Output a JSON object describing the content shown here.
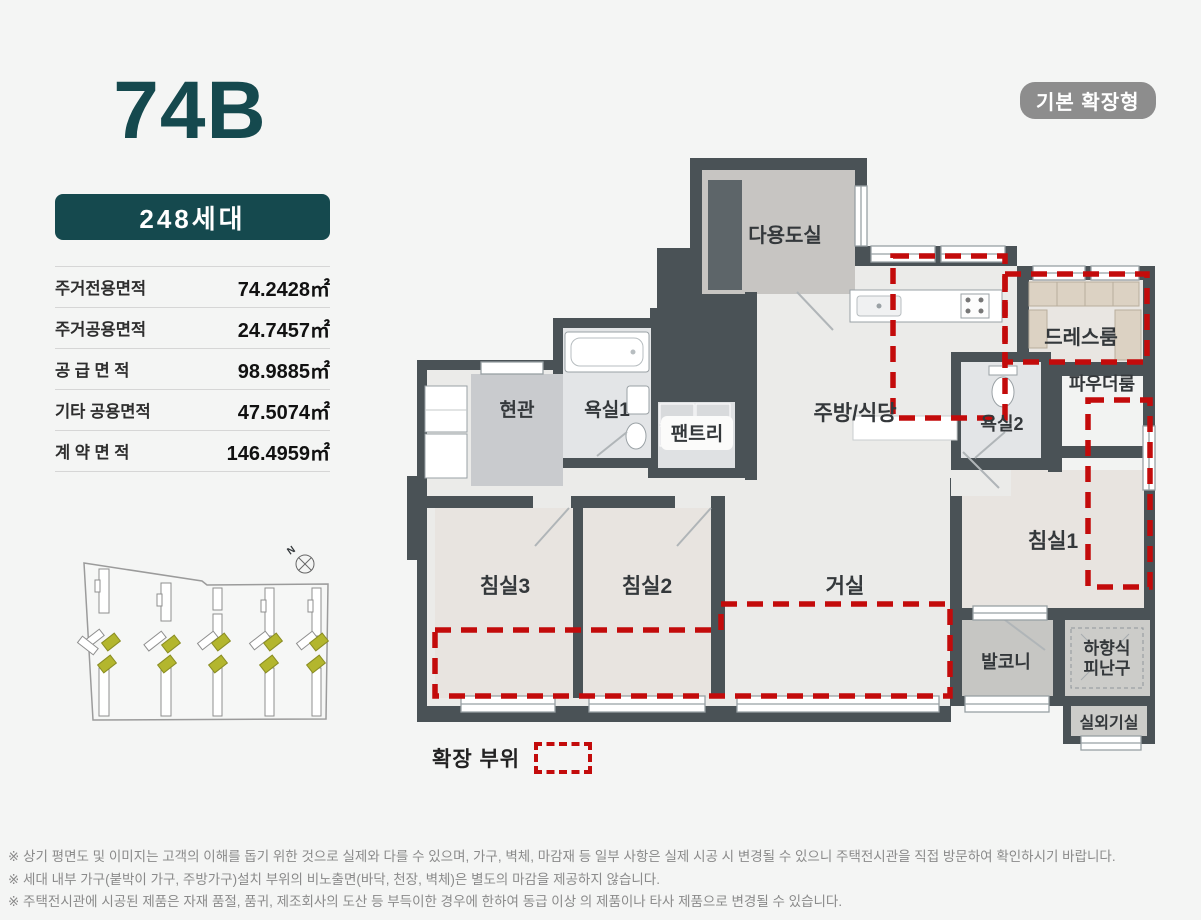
{
  "unit_panel": {
    "title": "74B",
    "households_badge": "248세대",
    "area_table": {
      "rows": [
        {
          "label": "주거전용면적",
          "value": "74.2428㎡"
        },
        {
          "label": "주거공용면적",
          "value": "24.7457㎡"
        },
        {
          "label": "공 급 면 적",
          "value": "98.9885㎡"
        },
        {
          "label": "기타 공용면적",
          "value": "47.5074㎡"
        },
        {
          "label": "계 약 면 적",
          "value": "146.4959㎡"
        }
      ]
    }
  },
  "plan": {
    "type_badge": "기본 확장형",
    "legend_label": "확장 부위",
    "compass_label": "N",
    "rooms": {
      "multipurpose": "다용도실",
      "entrance": "현관",
      "bath1": "욕실1",
      "pantry": "팬트리",
      "kitchen": "주방/식당",
      "dressroom": "드레스룸",
      "powder": "파우더룸",
      "bath2": "욕실2",
      "bed1": "침실1",
      "bed3": "침실3",
      "bed2": "침실2",
      "living": "거실",
      "balcony": "발코니",
      "escape_line1": "하향식",
      "escape_line2": "피난구",
      "outdoor_unit": "실외기실"
    },
    "colors": {
      "accent_teal": "#15494e",
      "expansion_red": "#c30b0b",
      "wall": "#4a5256",
      "type_badge_gray": "#8d8d8d"
    }
  },
  "footer": {
    "notes": [
      "※ 상기 평면도 및 이미지는 고객의 이해를 돕기 위한 것으로 실제와 다를 수 있으며, 가구, 벽체, 마감재 등 일부 사항은 실제 시공 시 변경될 수 있으니 주택전시관을 직접 방문하여 확인하시기 바랍니다.",
      "※ 세대 내부 가구(붙박이 가구, 주방가구)설치 부위의 비노출면(바닥, 천장, 벽체)은 별도의 마감을 제공하지 않습니다.",
      "※ 주택전시관에 시공된 제품은 자재 품절, 품귀, 제조회사의 도산 등 부득이한 경우에 한하여 동급 이상 의 제품이나 타사 제품으로 변경될 수 있습니다."
    ]
  }
}
